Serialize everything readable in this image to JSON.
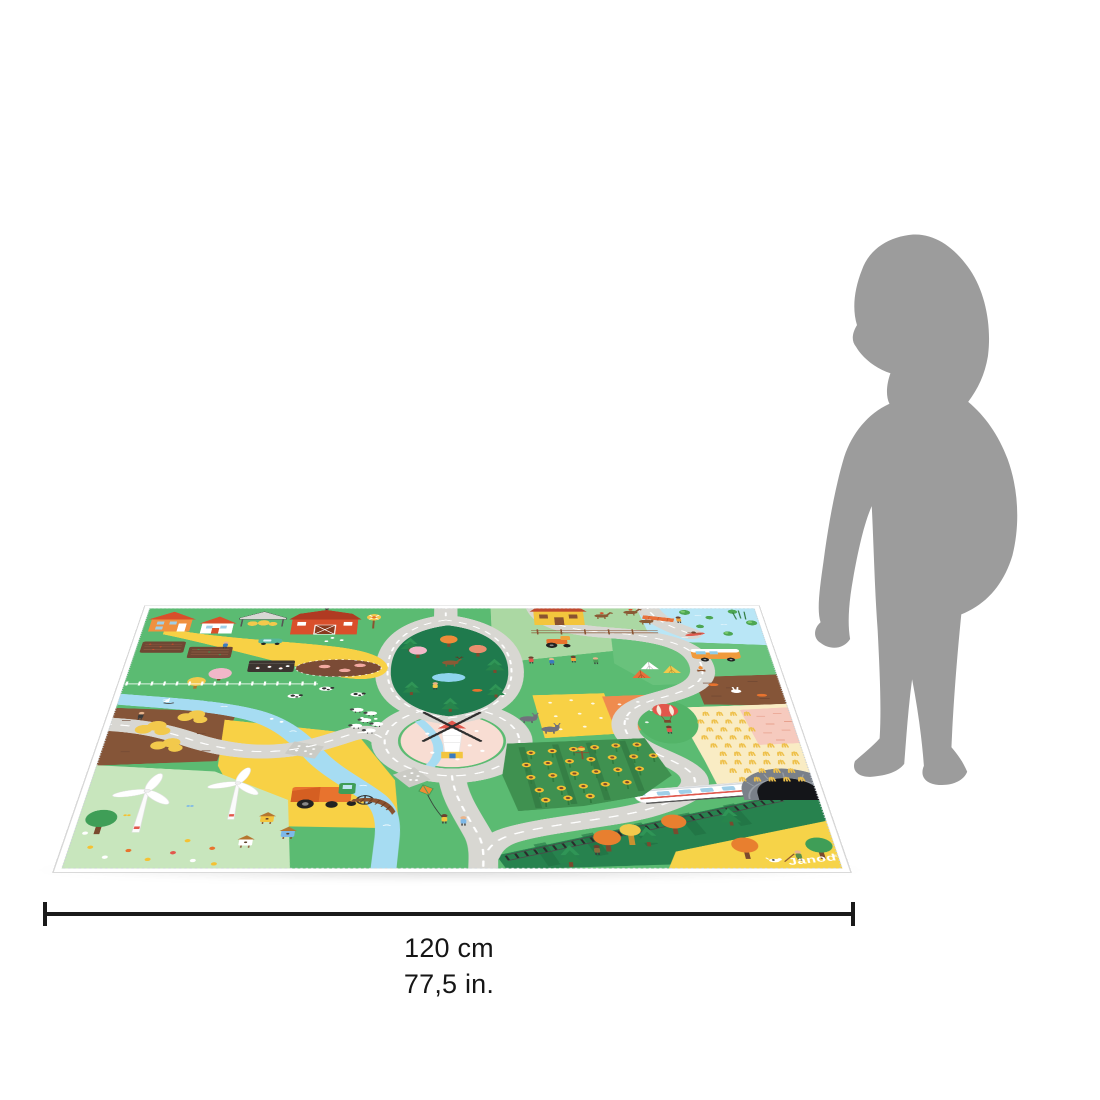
{
  "page": {
    "background_color": "#ffffff"
  },
  "product": {
    "type": "children's play mat product photo shown in perspective",
    "brand": {
      "logo": "Janod",
      "registered_mark": "®"
    },
    "mat": {
      "theme": "farm and countryside roadway play scene",
      "border_color": "#ffffff",
      "colors": {
        "grass": "#5bbb72",
        "light_grass": "#abd8a3",
        "pale_grass": "#c8e6bd",
        "road": "#d8d7d2",
        "road_dashes": "#ffffff",
        "river": "#a6dcf2",
        "lake": "#b9e6f6",
        "field_yellow": "#f8d145",
        "wheat": "#f9ecc4",
        "field_pink": "#f6cabe",
        "soil_brown": "#855538",
        "windmill_hill_pink": "#f8ddd3",
        "forest_green": "#1f7a4d",
        "autumn_orange": "#e87f2f",
        "barn_red": "#d94f2b"
      },
      "elements": [
        "farmhouses",
        "hay shelter",
        "red barn",
        "yellow pinwheel",
        "green car",
        "vegetable garden plots",
        "chicken coop",
        "pig pen",
        "picket fence",
        "cows",
        "blossom orchard trees",
        "winding gray roads with white dashes",
        "forest island with deer, fox and pond",
        "sheep flock",
        "stable with horse riders",
        "orange tractor",
        "hiking children",
        "lake with lily pads",
        "fishing dock",
        "kayak",
        "campsite tents",
        "camper van",
        "campfire",
        "hot air balloon with child",
        "rabbit and fox soil field",
        "wheat field",
        "pink flower field",
        "windmill on pink hill",
        "donkeys",
        "river with sailboat and ducks",
        "stone road crossings",
        "wooden bridge",
        "children flying a kite",
        "combine harvester",
        "wind turbines",
        "beehives",
        "flower meadow with butterflies",
        "sunflower field with scarecrow",
        "railway with high-speed train",
        "stone tunnel",
        "autumn forest",
        "gardener with dog",
        "Janod logo"
      ]
    }
  },
  "scale_reference": {
    "figure": "toddler silhouette standing beside mat",
    "color": "#9c9c9c"
  },
  "dimension": {
    "width_cm": "120 cm",
    "width_in": "77,5 in.",
    "line_color": "#1a1a1a"
  }
}
